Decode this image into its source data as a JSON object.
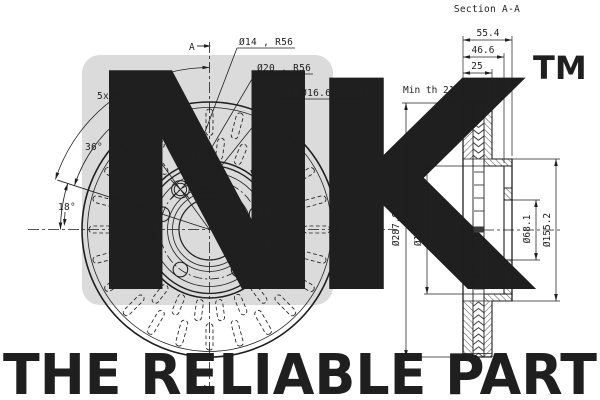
{
  "watermark": {
    "letter_n": "N",
    "letter_k": "K",
    "tm": "TM",
    "tagline": "THE RELIABLE PART"
  },
  "colors": {
    "line": "#1f1f1f",
    "thin_line": "#2b2b2b",
    "watermark_block": "#dbdbdb",
    "watermark_letter": "#ffffff",
    "watermark_gray": "#d2d2d2",
    "tagline_gray": "#d5d5d5",
    "background": "#ffffff"
  },
  "front_view": {
    "section_marker_top": "A",
    "section_marker_bottom": "A",
    "labels": {
      "pattern_angle": "5x72°",
      "angle_36": "36°",
      "angle_18": "18°",
      "hole_d14": "Ø14 , R56",
      "hole_d20": "Ø20 , R56",
      "bolt_holes": "5 X Ø16.6 , R56"
    }
  },
  "section_view": {
    "title": "Section A-A",
    "dim_overall_height": "55.4",
    "dim_hat_height": "46.6",
    "dim_thickness": "25",
    "dim_min_thickness": "Min th 21",
    "dim_outer_dia": "Ø287.8",
    "dim_inner_dia": "Ø145.8",
    "dim_bore_dia": "Ø68.1",
    "dim_hat_dia": "Ø155.2"
  }
}
